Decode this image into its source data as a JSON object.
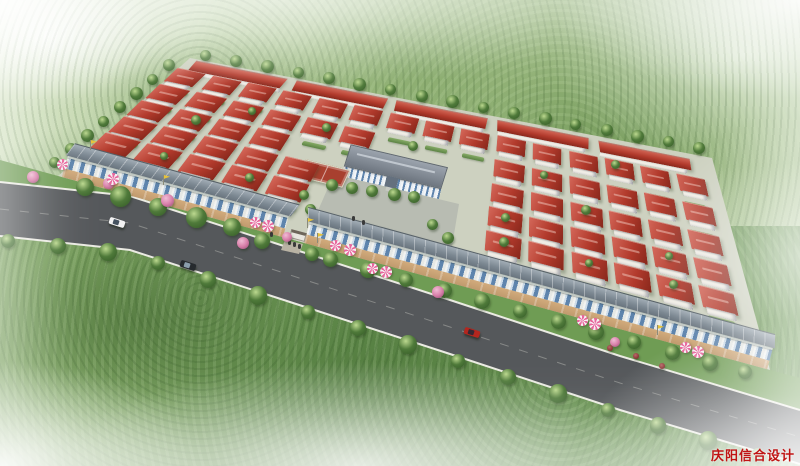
{
  "scene": {
    "type": "aerial-architectural-rendering",
    "description": "Bird's-eye rendering of a planned residential community: perspective grid of white houses with red hip roofs, terraced row houses along the back boundary, a central public building with flag plaza and red basketball court, two street-front shop rows with pink parasols and yellow pennant flags, a curving tree-lined main road with three cars, all surrounded by misty green fields fading to white at the edges"
  },
  "watermark": {
    "text": "庆阳信合设计",
    "color": "#c01414"
  },
  "palette": {
    "house_roof": "#b23a2c",
    "house_roof_light": "#d4685a",
    "house_wall": "#f3f0e8",
    "shop_roof": "#7b8791",
    "shop_glass": "#5e84ad",
    "sidewalk": "#c09a6e",
    "building_roof": "#7e8690",
    "building_wall": "#eef2f6",
    "court": "#a8402f",
    "plaza": "#b8bcb2",
    "ground": "#cdd1c0",
    "road": "#55585b",
    "curb": "#ebebe3",
    "verge_green": "#6f9c54",
    "gate_path": "#b9b3a4",
    "tree_green": "#4f7a3a",
    "blossom_pink": "#d981ab",
    "umbrella_pink": "#e8679d",
    "flag_yellow": "#e8c33a",
    "car_white": "#f2f2f2",
    "car_dark": "#262a2e",
    "car_red": "#b3261e"
  },
  "objects": {
    "cars": [
      "white",
      "dark",
      "red"
    ],
    "umbrella_count": 12,
    "flag_count": 5
  }
}
